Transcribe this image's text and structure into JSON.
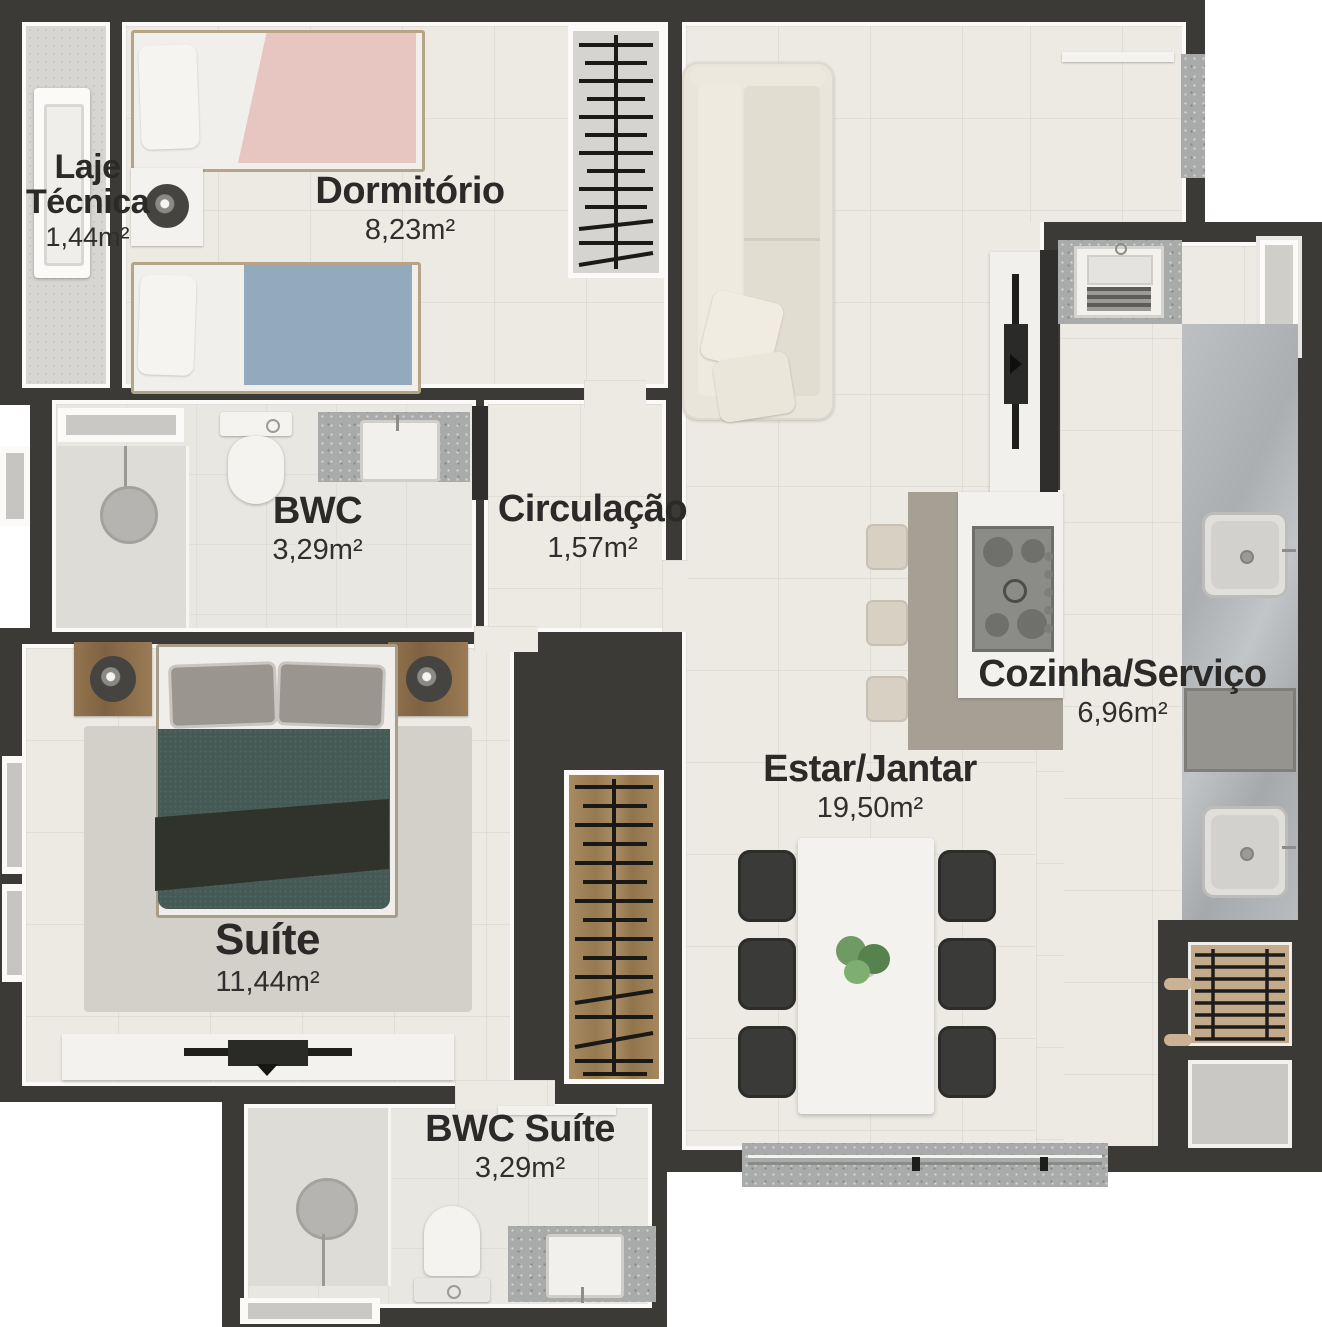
{
  "rooms": {
    "laje_tecnica": {
      "name": "Laje Técnica",
      "area": "1,44m²"
    },
    "dormitorio": {
      "name": "Dormitório",
      "area": "8,23m²"
    },
    "bwc": {
      "name": "BWC",
      "area": "3,29m²"
    },
    "circulacao": {
      "name": "Circulação",
      "area": "1,57m²"
    },
    "cozinha_servico": {
      "name": "Cozinha/Serviço",
      "area": "6,96m²"
    },
    "estar_jantar": {
      "name": "Estar/Jantar",
      "area": "19,50m²"
    },
    "suite": {
      "name": "Suíte",
      "area": "11,44m²"
    },
    "bwc_suite": {
      "name": "BWC Suíte",
      "area": "3,29m²"
    }
  },
  "colors": {
    "wall": "#3b3a37",
    "floor_tile": "#edeae3",
    "label_text": "#2b2a28",
    "counter_gray": "#a9abaa",
    "accent_pink": "#e7c6c2",
    "accent_blue": "#93aabc",
    "accent_teal": "#455a55",
    "wood": "#97794f"
  }
}
